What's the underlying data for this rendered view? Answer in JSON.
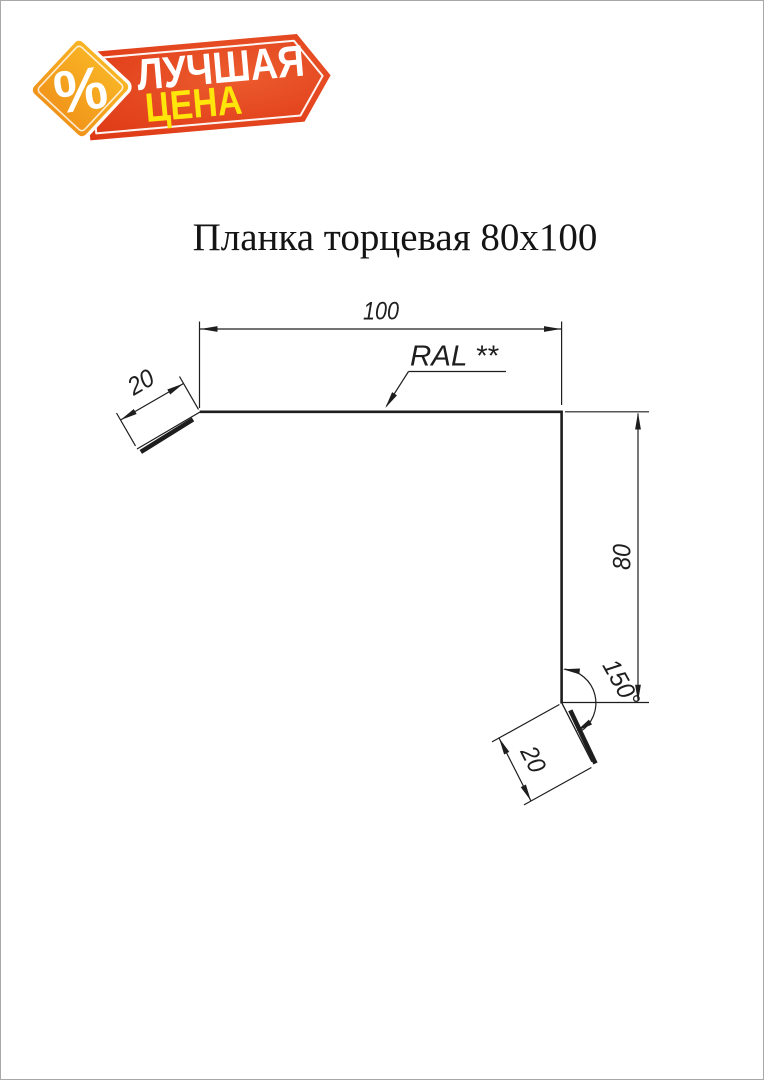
{
  "page": {
    "background": "#ffffff",
    "border_color": "#a8a8a8"
  },
  "badge": {
    "percent": "%",
    "line1": "ЛУЧШАЯ",
    "line2": "ЦЕНА",
    "colors": {
      "banner_red": "#de3715",
      "banner_red_light": "#ec5c2e",
      "diamond_orange_top": "#f9b525",
      "diamond_orange_bottom": "#f0931a",
      "line1_color": "#ffffff",
      "line2_color": "#ffe50a"
    }
  },
  "title": "Планка торцевая 80х100",
  "drawing": {
    "line_color": "#1e1e1e",
    "coating_label": "RAL **",
    "dim_top_width": "100",
    "dim_left_hem": "20",
    "dim_height": "80",
    "dim_angle": "150°",
    "dim_bottom_hem": "20",
    "dimensions": {
      "width_mm": 100,
      "height_mm": 80,
      "hem_mm": 20,
      "angle_deg": 150
    }
  }
}
